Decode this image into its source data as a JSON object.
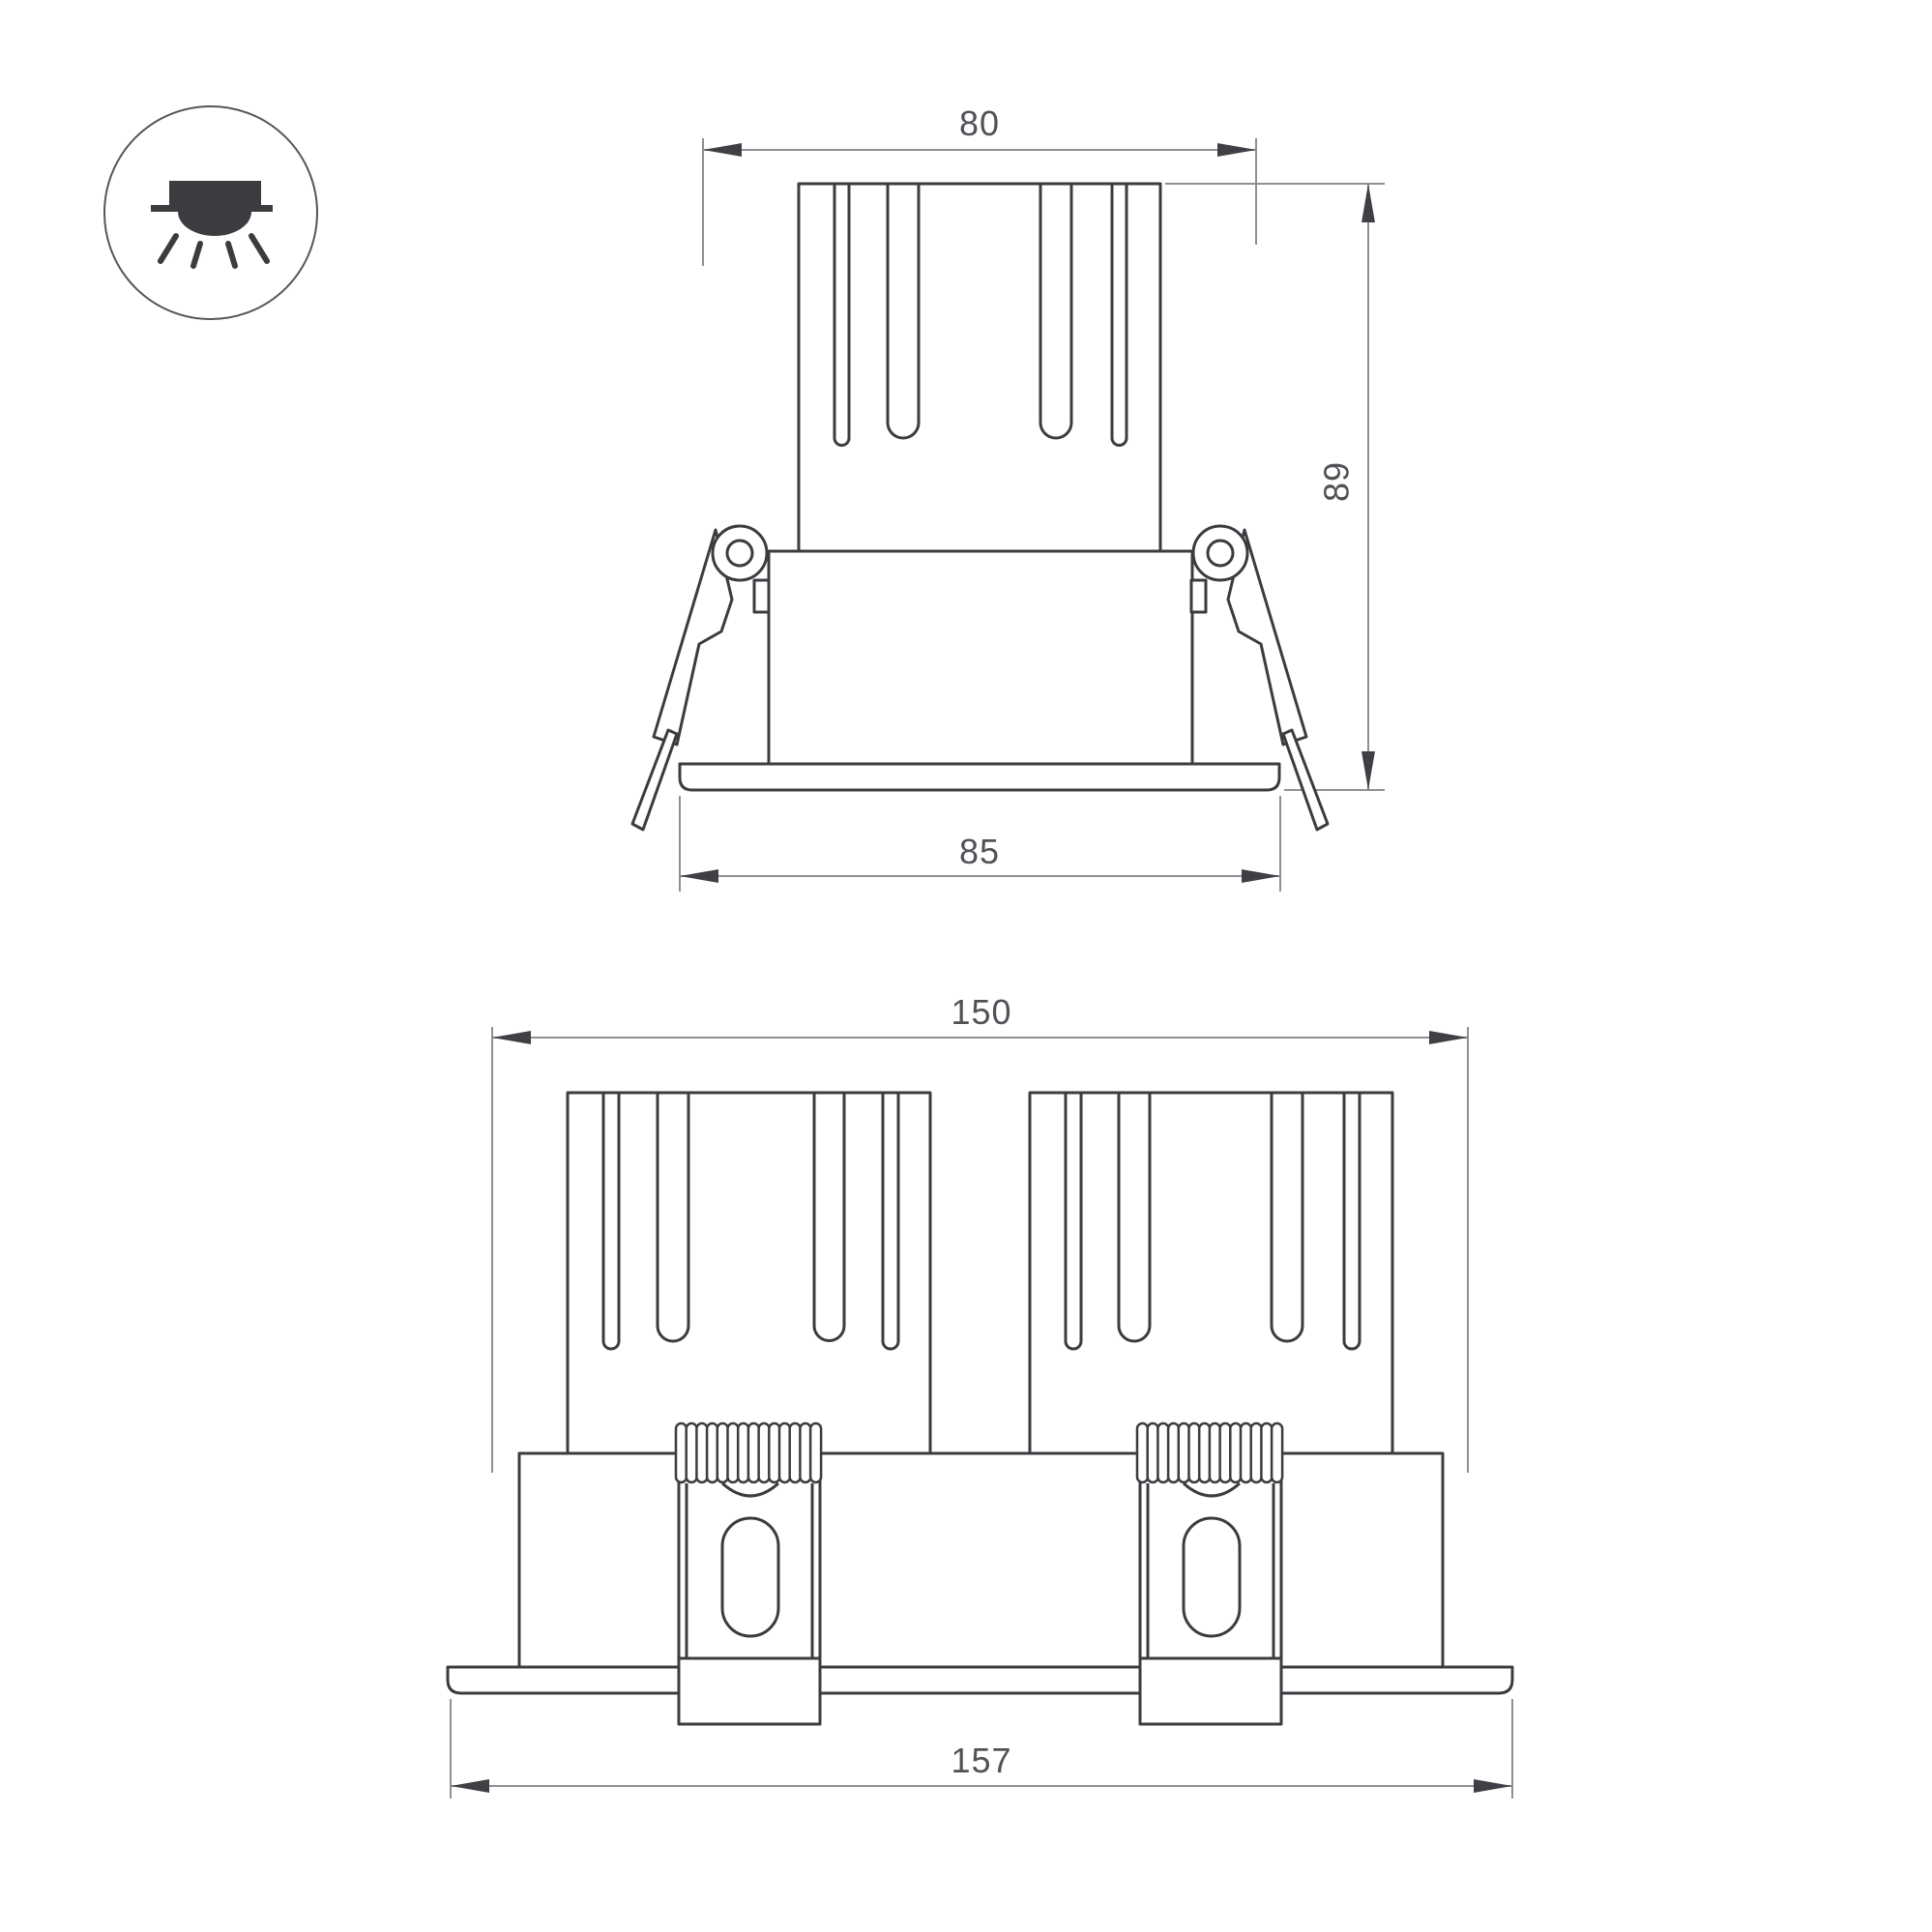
{
  "document": {
    "kind": "luminaire-dimension-drawing",
    "views": [
      "front-single",
      "front-double"
    ]
  },
  "colors": {
    "background": "#ffffff",
    "outline": "#3b3c40",
    "dimension_line": "#8f9093",
    "arrow": "#3f4045",
    "dimension_text": "#515257",
    "icon_stroke": "#55565a",
    "icon_fill": "#3b3c40",
    "white": "#ffffff"
  },
  "icon": {
    "name": "recessed-downlight",
    "description": "recessed ceiling light with rays"
  },
  "front_view": {
    "dimensions": {
      "cutout_width": "80",
      "height": "89",
      "flange_width": "85"
    }
  },
  "double_view": {
    "dimensions": {
      "body_width": "150",
      "flange_width": "157"
    }
  }
}
